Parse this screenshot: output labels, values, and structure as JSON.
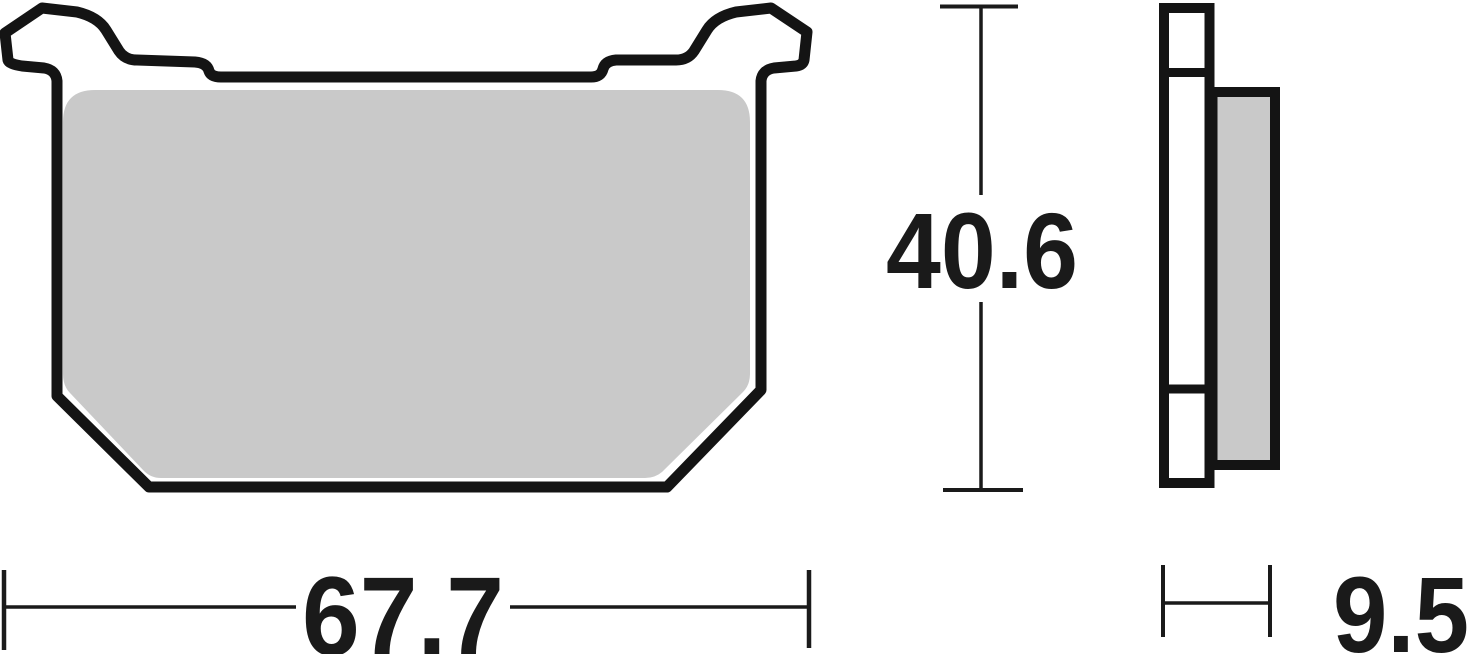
{
  "drawing": {
    "title": "brake-pad-technical-drawing",
    "views": {
      "front": {
        "name": "front-view"
      },
      "side": {
        "name": "side-view"
      }
    },
    "dimensions": {
      "width_label": "67.7",
      "height_label": "40.6",
      "thickness_label": "9.5"
    },
    "colors": {
      "outline": "#141414",
      "friction": "#c9c9c9",
      "plate_fill": "#ffffff",
      "dimension": "#1a1a1a",
      "background": "#ffffff"
    }
  }
}
